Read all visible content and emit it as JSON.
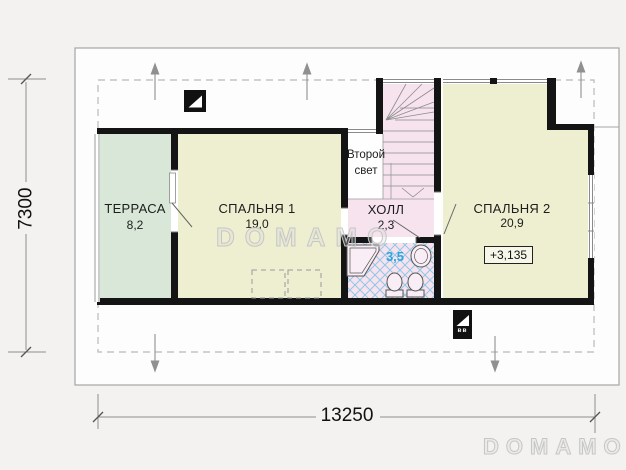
{
  "rooms": {
    "terrace": {
      "name": "ТЕРРАСА",
      "area": "8,2"
    },
    "bedroom1": {
      "name": "СПАЛЬНЯ 1",
      "area": "19,0"
    },
    "second_light": {
      "line1": "Второй",
      "line2": "свет"
    },
    "hall": {
      "name": "ХОЛЛ",
      "area": "2,3"
    },
    "bathroom": {
      "area": "3,5"
    },
    "bedroom2": {
      "name": "СПАЛЬНЯ 2",
      "area": "20,9",
      "level_mark": "+3,135"
    }
  },
  "dimensions": {
    "width": "13250",
    "height": "7300"
  },
  "vent_label": "вв",
  "watermark": "DOMAMO",
  "logo": "DOMAMO",
  "colors": {
    "wall": "#141414",
    "terrace_fill": "#d8e7d7",
    "bedroom_fill": "#eeefd1",
    "wet_fill": "#f6e3ee",
    "tile_line": "#79bfe6",
    "area_accent": "#2ba3dc",
    "dim_line": "#8f8f8f"
  }
}
